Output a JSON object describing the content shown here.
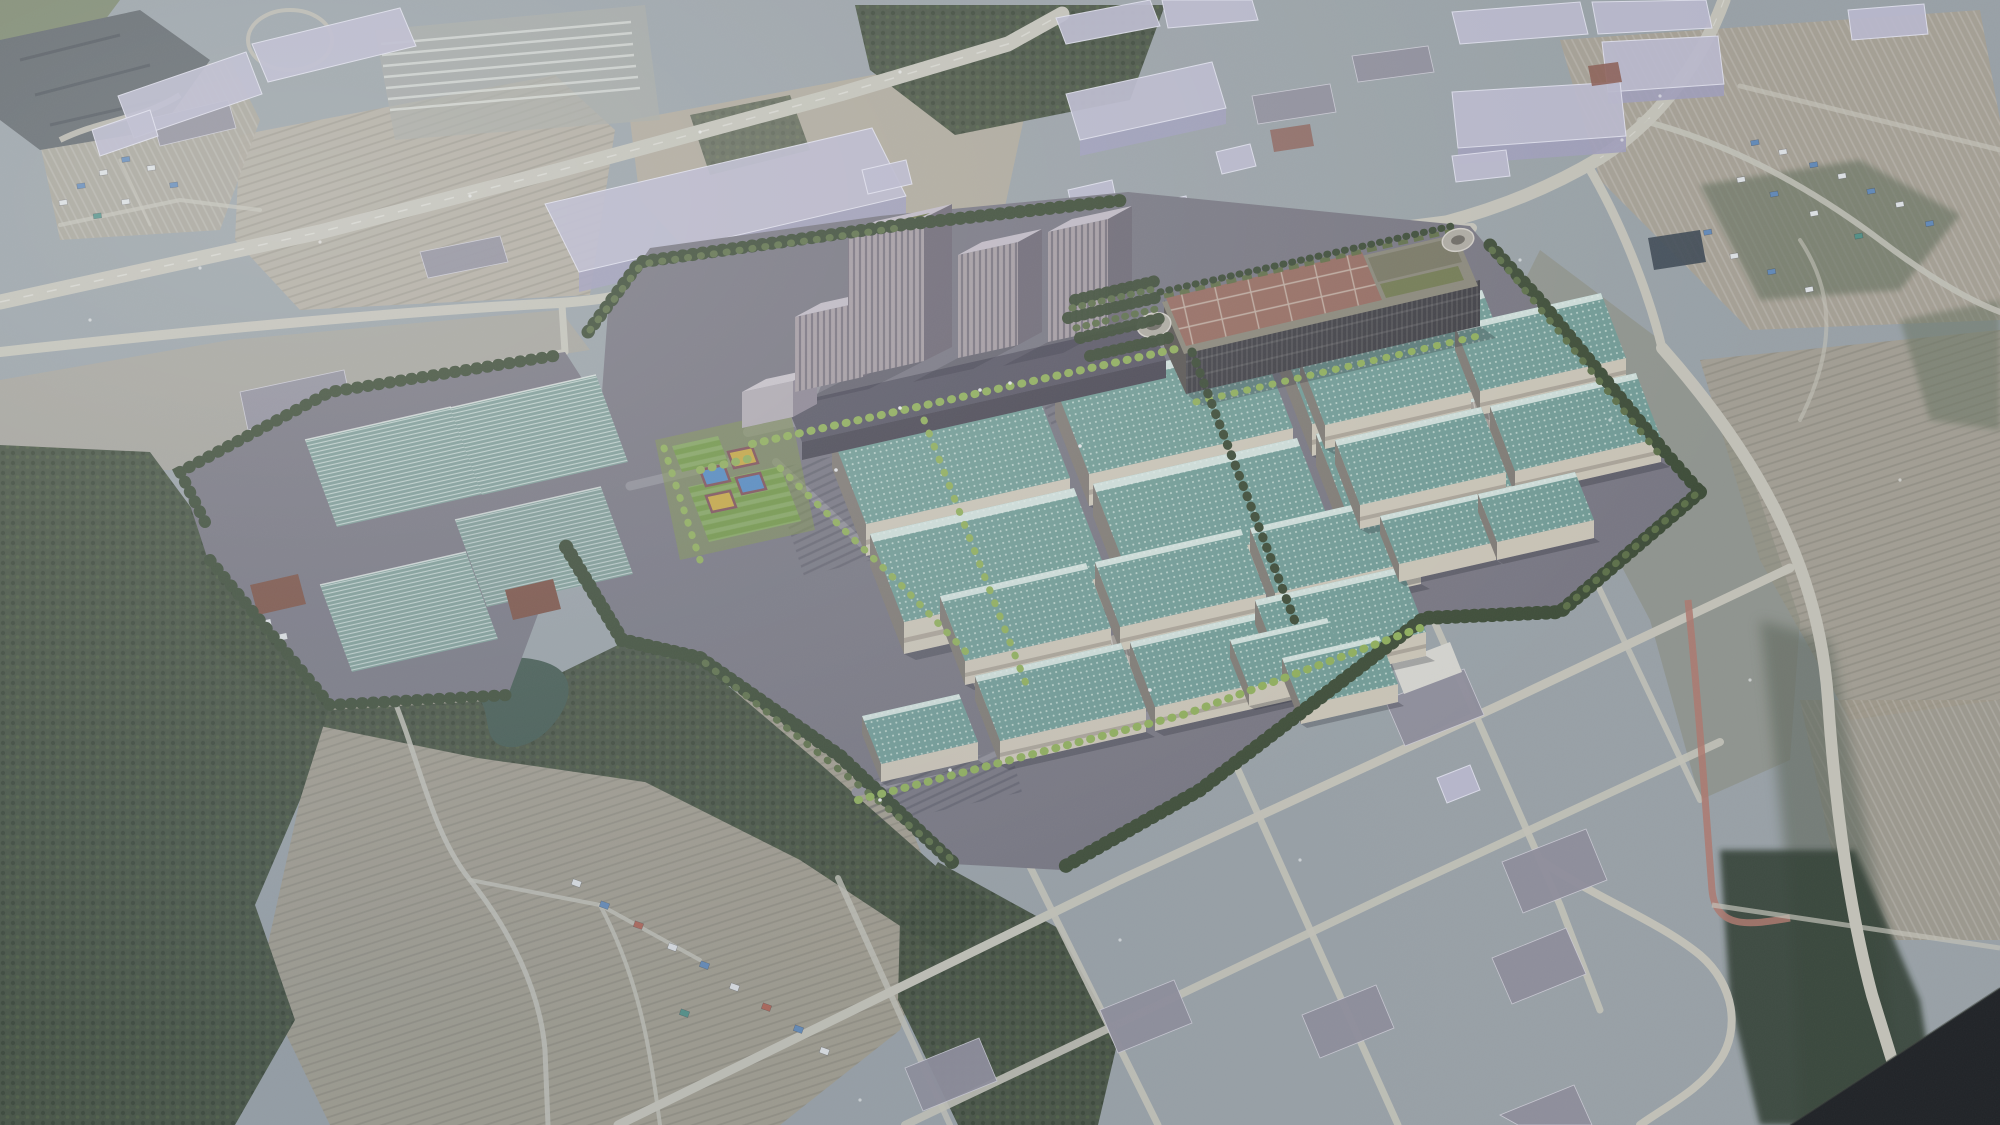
{
  "meta": {
    "title": "Oblique aerial 3D rendering of a planned industrial campus over satellite terrain",
    "image_kind": "architectural-visualization-aerial",
    "width_px": 2000,
    "height_px": 1125,
    "visible_text": "none"
  },
  "palette": {
    "terrainBase": "#99a0a5",
    "terrainField": "#a9a193",
    "terrainDirt": "#b2a898",
    "terrainPale": "#b6ad9e",
    "forestDark": "#3e4937",
    "forestMid": "#55624a",
    "scrub": "#8b8a7c",
    "roadLight": "#c6c3b8",
    "roadWhite": "#e8e6de",
    "roadRed": "#b0766a",
    "trackRed": "#b05a4a",
    "campusGround": "#76737e",
    "campusPaved": "#8e8b94",
    "plazaLight": "#a3a0a8",
    "hallRoof": "#6f9a93",
    "hallRoofDot": "#cfe0da",
    "hallRidge": "#e3ece8",
    "hallWall": "#cdc5b6",
    "hallSide": "#7e7770",
    "shedRoof": "#a39b93",
    "shedRib": "#e8e4dc",
    "towerFace": "#a59aa0",
    "towerStripe": "#4a4454",
    "towerSide": "#6b6470",
    "towerTop": "#c2bac4",
    "towerGreen": "#6a7342",
    "podium": "#565260",
    "parkBody": "#3b393e",
    "parkRoof": "#96685c",
    "parkGrid": "#c9b7a9",
    "parkGarden": "#8a8576",
    "rampConc": "#b0aaa0",
    "massing": "#bdbacf",
    "massingSide": "#a09cba",
    "massingEdge": "#e6e4f2",
    "grayRoof": "#8f8c9a",
    "whiteRoof": "#d8d6d0",
    "redRoofSmall": "#8c5a50",
    "treeDark": "#38462f",
    "treeHi": "#5a6c42",
    "treeLight": "#8fae56",
    "lawn": "#7d9048",
    "fieldGreen": "#6f9440",
    "courtBlue": "#4f86c0",
    "courtYellow": "#c8a63c",
    "courtMaroon": "#7c4a52",
    "ghTeal": "#7d9b94",
    "ghStripe": "#dfe8e4",
    "shedBrown": "#7a4c3e",
    "pond": "#3f544a",
    "solarDark": "#39434e",
    "wedgeDark": "#17181c",
    "houseBlue": "#5f87b8",
    "houseWhite": "#e2e4e6",
    "houseRed": "#b06050",
    "houseTeal": "#4f8f84",
    "hazeBlue": "#8fa0b4"
  },
  "scene": {
    "regions": [
      {
        "name": "aerial-terrain",
        "description": "Muted blue-gray oblique satellite basemap with fields, roads and haze"
      },
      {
        "name": "quarry-corner",
        "description": "Dark rocky quarry at the top-left corner"
      },
      {
        "name": "expressway",
        "description": "Wide highway running diagonally across the upper-left"
      },
      {
        "name": "right-highway",
        "description": "Highway curving down from the top-right corner past the campus"
      },
      {
        "name": "massing-blocks",
        "description": "Semi-transparent lavender 3D massing boxes over existing industrial lots"
      },
      {
        "name": "rendered-campus",
        "description": "Central 3D-rendered industrial campus on dark paved plateau"
      },
      {
        "name": "office-towers",
        "description": "Cluster of four striped high-rise towers with a dark podium"
      },
      {
        "name": "parking-structure",
        "description": "Large dark slatted structure with red-brown gridded roof, roof gardens and oval ramps"
      },
      {
        "name": "factory-halls",
        "description": "Rows of large factory halls with teal panelled roofs and light concrete walls"
      },
      {
        "name": "greenhouse-arrays",
        "description": "Striped teal greenhouse/panel arrays on the western wing with brown sheds"
      },
      {
        "name": "sports-fields",
        "description": "Green pitches with blue and yellow courts framed in maroon"
      },
      {
        "name": "perimeter-forest",
        "description": "Dark evergreen tree belts around the campus and bottom-left hills"
      },
      {
        "name": "rural-valley",
        "description": "Terraced farmland, winding lanes, a dark pond and village houses, bottom-left"
      },
      {
        "name": "industrial-grid",
        "description": "Existing gridded industrial lots with gray warehouses, bottom-right"
      },
      {
        "name": "village-top-right",
        "description": "Small village with blue and white roofs among fields, top-right"
      },
      {
        "name": "model-edge-wedge",
        "description": "Near-black triangular cut of the 3D model at the bottom-right corner"
      }
    ]
  }
}
